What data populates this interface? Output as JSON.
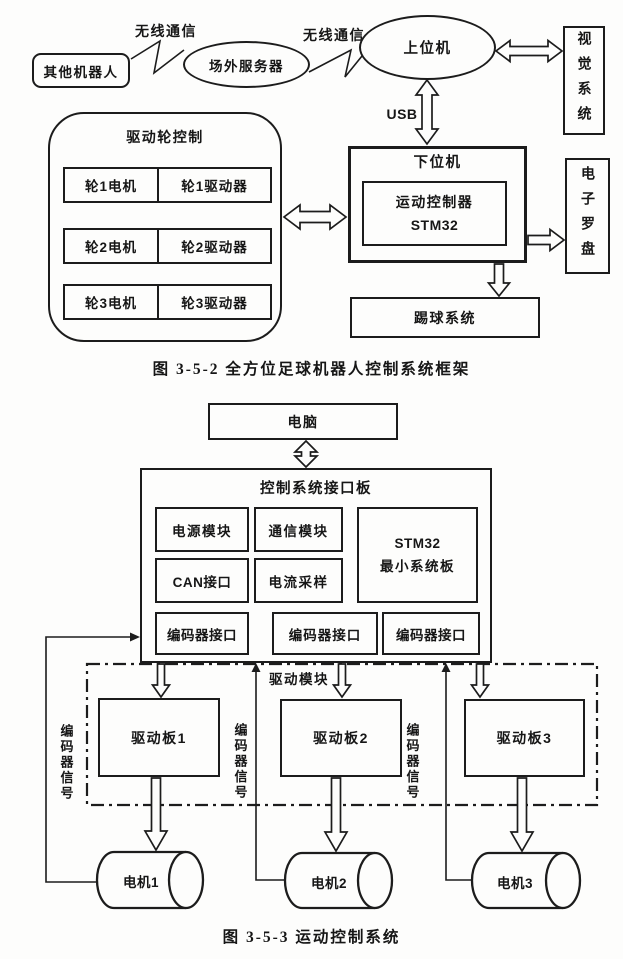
{
  "colors": {
    "outline": "#1c1c1c",
    "paper": "#fdfdfc"
  },
  "figure1": {
    "caption": "图 3-5-2  全方位足球机器人控制系统框架",
    "other_robots": "其他机器人",
    "wireless_link_1": "无线通信",
    "offsite_server": "场外服务器",
    "wireless_link_2": "无线通信",
    "host_computer": "上位机",
    "vision_system": "视觉系统",
    "usb_label": "USB",
    "lower_computer": "下位机",
    "motion_controller": {
      "line1": "运动控制器",
      "line2": "STM32"
    },
    "electronic_compass": "电子罗盘",
    "kicking_system": "踢球系统",
    "drive_wheel_control": {
      "title": "驱动轮控制",
      "rows": [
        {
          "motor": "轮1电机",
          "driver": "轮1驱动器"
        },
        {
          "motor": "轮2电机",
          "driver": "轮2驱动器"
        },
        {
          "motor": "轮3电机",
          "driver": "轮3驱动器"
        }
      ]
    }
  },
  "figure2": {
    "caption": "图 3-5-3  运动控制系统",
    "computer": "电脑",
    "interface_board": {
      "title": "控制系统接口板",
      "power_module": "电源模块",
      "comm_module": "通信模块",
      "stm32_board": {
        "line1": "STM32",
        "line2": "最小系统板"
      },
      "can_interface": "CAN接口",
      "current_sampling": "电流采样",
      "encoder_interfaces": [
        "编码器接口",
        "编码器接口",
        "编码器接口"
      ]
    },
    "drive_module": {
      "title": "驱动模块",
      "boards": [
        "驱动板1",
        "驱动板2",
        "驱动板3"
      ]
    },
    "encoder_signal_labels": [
      "编码器信号",
      "编码器信号",
      "编码器信号"
    ],
    "motors": [
      "电机1",
      "电机2",
      "电机3"
    ]
  }
}
